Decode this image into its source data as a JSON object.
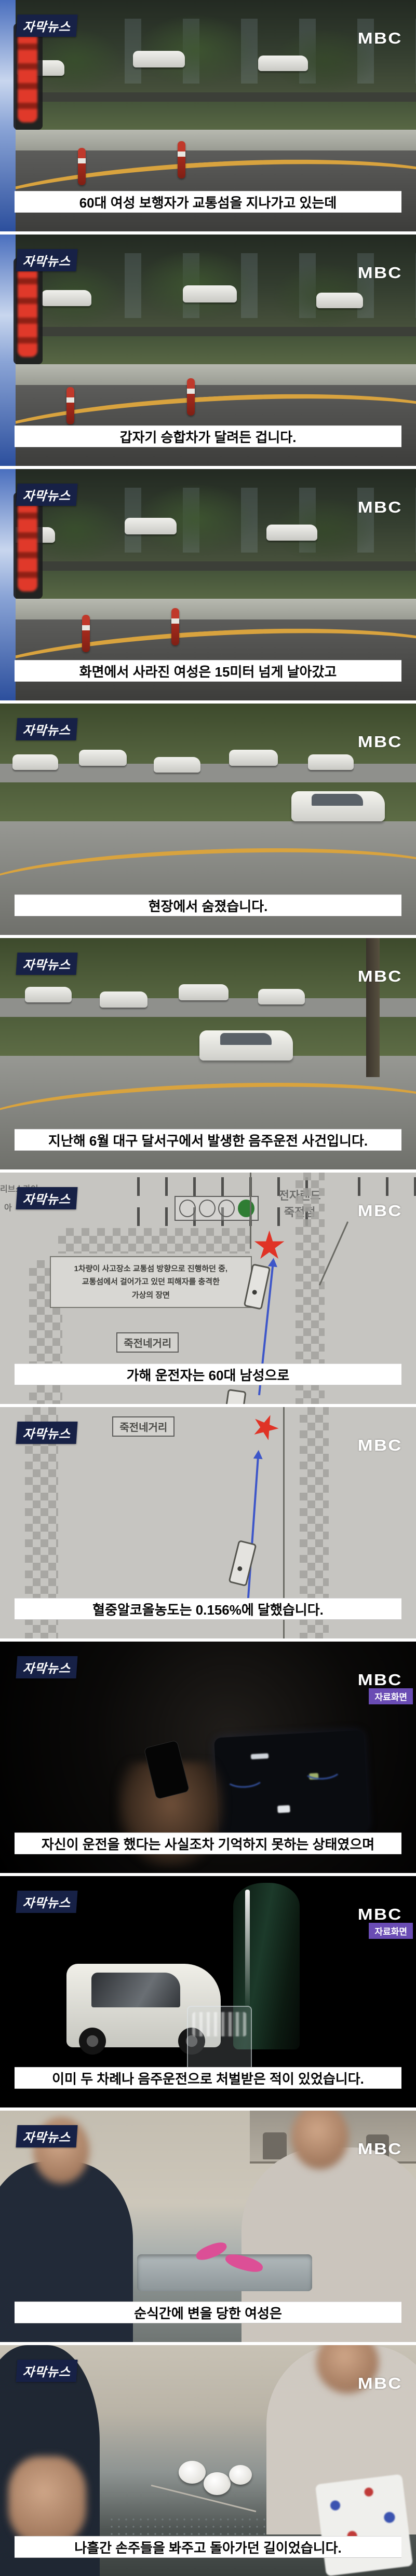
{
  "brand": {
    "program_badge": "자막뉴스",
    "network_logo": "MBC",
    "source_badge": "자료화면"
  },
  "colors": {
    "caption_bg": "#ffffff",
    "caption_text": "#050505",
    "program_badge_bg": "#172146",
    "source_badge_bg": "#6a4cb4",
    "curb_line_yellow": "#d9a33e",
    "collision_mark_red": "#e03326",
    "path_arrow_blue": "#3d56c9"
  },
  "frames": [
    {
      "caption": "60대 여성 보행자가 교통섬을 지나가고 있는데",
      "scene": "dashcam-intersection",
      "source_badge": false
    },
    {
      "caption": "갑자기 승합차가 달려든 겁니다.",
      "scene": "dashcam-intersection",
      "source_badge": false
    },
    {
      "caption": "화면에서 사라진 여성은 15미터 넘게 날아갔고",
      "scene": "dashcam-intersection",
      "source_badge": false
    },
    {
      "caption": "현장에서 숨졌습니다.",
      "scene": "street-wide",
      "source_badge": false
    },
    {
      "caption": "지난해 6월 대구 달서구에서 발생한 음주운전 사건입니다.",
      "scene": "street-wide",
      "source_badge": false
    },
    {
      "caption": "가해 운전자는 60대 남성으로",
      "scene": "accident-report-sketch",
      "source_badge": false
    },
    {
      "caption": "혈중알코올농도는 0.156%에 달했습니다.",
      "scene": "accident-report-sketch",
      "source_badge": false
    },
    {
      "caption": "자신이 운전을 했다는 사실조차 기억하지 못하는 상태였으며",
      "scene": "car-interior",
      "source_badge": true
    },
    {
      "caption": "이미 두 차례나 음주운전으로 처벌받은 적이 있었습니다.",
      "scene": "soju-toy-car-still",
      "source_badge": true
    },
    {
      "caption": "순식간에 변을 당한 여성은",
      "scene": "kitchen-interview",
      "source_badge": false
    },
    {
      "caption": "나흘간 손주들을 봐주고 돌아가던 길이었습니다.",
      "scene": "kitchen-interview-close",
      "source_badge": false
    }
  ],
  "sketch": {
    "store_label": "전자랜드\n죽전점",
    "note": "1차량이 사고장소 교통섬 방향으로 진행하던 중,\n교통섬에서 걸어가고 있던 피해자를 충격한\n가상의 장면",
    "junction_label": "죽전네거리",
    "partial_label_1": "리브스카이",
    "partial_label_2": "아"
  }
}
